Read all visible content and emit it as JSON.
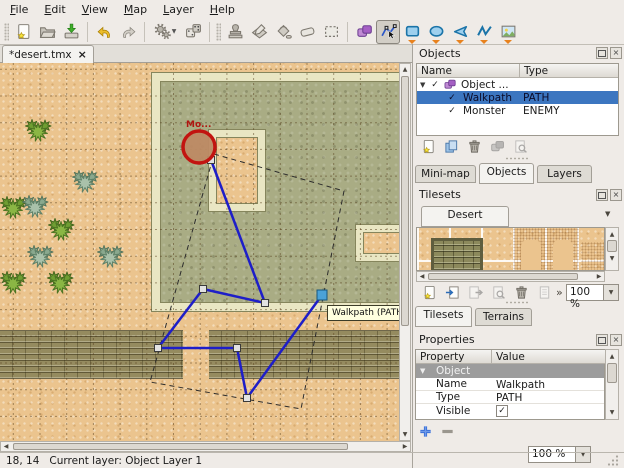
{
  "icons": {
    "close": "×",
    "check": "✓",
    "dropdown": "▼",
    "up": "▲",
    "down": "▼",
    "left": "◀",
    "right": "▶",
    "expander_open": "▼",
    "overflow": "»"
  },
  "colors": {
    "selection_blue": "#3c76c0",
    "path_blue": "#1e1ec8",
    "monster_red": "#c21410",
    "tooltip_bg": "#ffffdf",
    "sand": "#ebc48e",
    "stone": "#a9ac84",
    "wall": "#e9e6c3",
    "brick": "#958b5f"
  },
  "menu": {
    "items": [
      "File",
      "Edit",
      "View",
      "Map",
      "Layer",
      "Help"
    ]
  },
  "toolbar": {
    "active_tool": "edit-polygons"
  },
  "document_tab": {
    "title": "*desert.tmx"
  },
  "map_view": {
    "monster_label": "Mo...",
    "tooltip": "Walkpath (PATH)",
    "geometry": {
      "grid": {
        "spacing": 26.7,
        "offset_x": 13.3,
        "offset_y": 6.3
      },
      "tiles": [
        {
          "type": "building",
          "x": 152,
          "y": 10,
          "w": 260,
          "h": 238
        },
        {
          "type": "courtyard",
          "x": 209,
          "y": 67,
          "w": 56,
          "h": 81
        },
        {
          "type": "opening",
          "x": 356,
          "y": 162,
          "w": 50,
          "h": 36
        },
        {
          "type": "brick",
          "x": 0,
          "y": 267,
          "w": 183,
          "h": 49
        },
        {
          "type": "brick",
          "x": 209,
          "y": 267,
          "w": 196,
          "h": 49
        }
      ],
      "cacti": [
        {
          "x": 25,
          "y": 53,
          "v": "green"
        },
        {
          "x": 72,
          "y": 104,
          "v": "sage"
        },
        {
          "x": 0,
          "y": 130,
          "v": "green"
        },
        {
          "x": 22,
          "y": 129,
          "v": "sage"
        },
        {
          "x": 48,
          "y": 152,
          "v": "green"
        },
        {
          "x": 27,
          "y": 179,
          "v": "sage"
        },
        {
          "x": 97,
          "y": 179,
          "v": "sage"
        },
        {
          "x": 0,
          "y": 205,
          "v": "green"
        },
        {
          "x": 47,
          "y": 205,
          "v": "green"
        }
      ],
      "selection_box": [
        [
          214,
          91
        ],
        [
          344,
          128
        ],
        [
          301,
          346
        ],
        [
          150,
          319
        ]
      ],
      "polyline": [
        [
          211,
          97
        ],
        [
          265,
          240
        ],
        [
          203,
          226
        ],
        [
          158,
          285
        ],
        [
          237,
          285
        ],
        [
          247,
          335
        ],
        [
          322,
          232
        ]
      ],
      "selected_node_index": 6,
      "monster_circle": {
        "cx": 199,
        "cy": 84,
        "r": 16
      },
      "monster_label_pos": [
        186,
        57
      ],
      "tooltip_pos": [
        327,
        242
      ]
    }
  },
  "objects_panel": {
    "title": "Objects",
    "columns": [
      "Name",
      "Type"
    ],
    "rows": [
      {
        "name": "Object ...",
        "type": ""
      },
      {
        "name": "Walkpath",
        "type": "PATH"
      },
      {
        "name": "Monster",
        "type": "ENEMY"
      }
    ]
  },
  "view_tabs": {
    "tabs": [
      "Mini-map",
      "Objects",
      "Layers"
    ],
    "active": "Objects"
  },
  "tilesets_panel": {
    "title": "Tilesets",
    "active_tileset": "Desert",
    "zoom_value": "100 %"
  },
  "tileset_tabs": {
    "tabs": [
      "Tilesets",
      "Terrains"
    ],
    "active": "Tilesets"
  },
  "properties_panel": {
    "title": "Properties",
    "columns": [
      "Property",
      "Value"
    ],
    "group_label": "Object",
    "rows": [
      {
        "property": "Name",
        "value": "Walkpath"
      },
      {
        "property": "Type",
        "value": "PATH"
      },
      {
        "property": "Visible",
        "value": ""
      }
    ]
  },
  "statusbar": {
    "coords": "18, 14",
    "current_layer": "Current layer: Object Layer 1",
    "zoom_value": "100 %"
  }
}
